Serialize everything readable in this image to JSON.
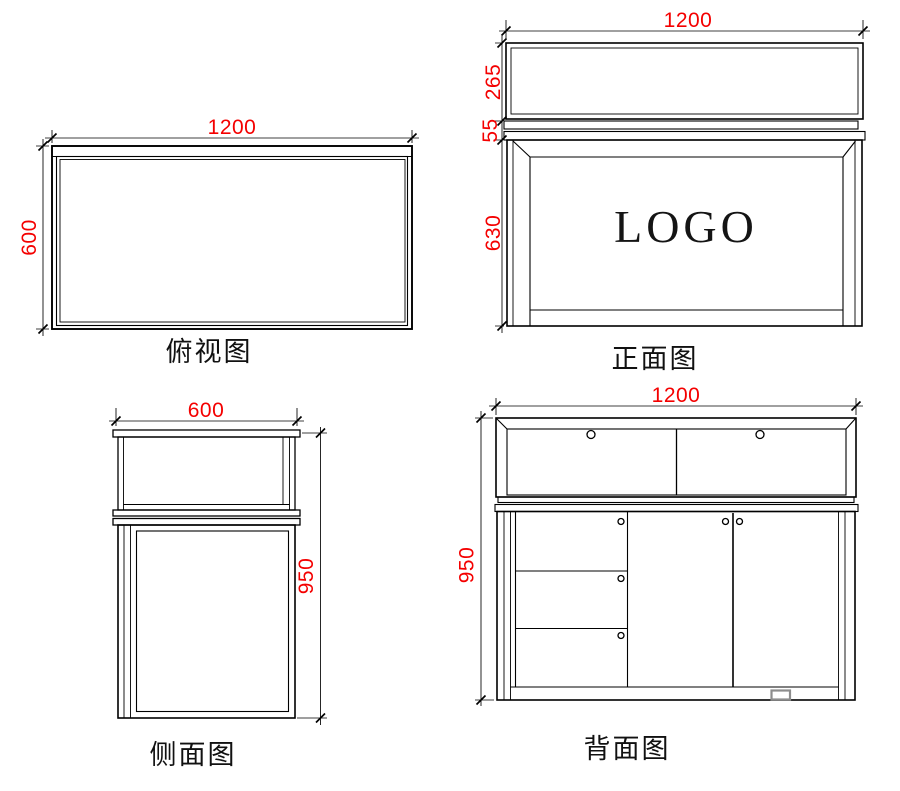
{
  "colors": {
    "line": "#000000",
    "dimension_text": "#f40000",
    "hatch_line": "#999999",
    "vent_outline": "#8d8d8d"
  },
  "views": {
    "top": {
      "label": "俯视图",
      "dim_width": "1200",
      "dim_depth": "600"
    },
    "front": {
      "label": "正面图",
      "logo": "LOGO",
      "dim_width": "1200",
      "dim_glass_height": "265",
      "dim_counter_height": "55",
      "dim_cabinet_height": "630"
    },
    "side": {
      "label": "侧面图",
      "dim_depth": "600",
      "dim_height": "950"
    },
    "back": {
      "label": "背面图",
      "dim_width": "1200",
      "dim_height": "950"
    }
  }
}
